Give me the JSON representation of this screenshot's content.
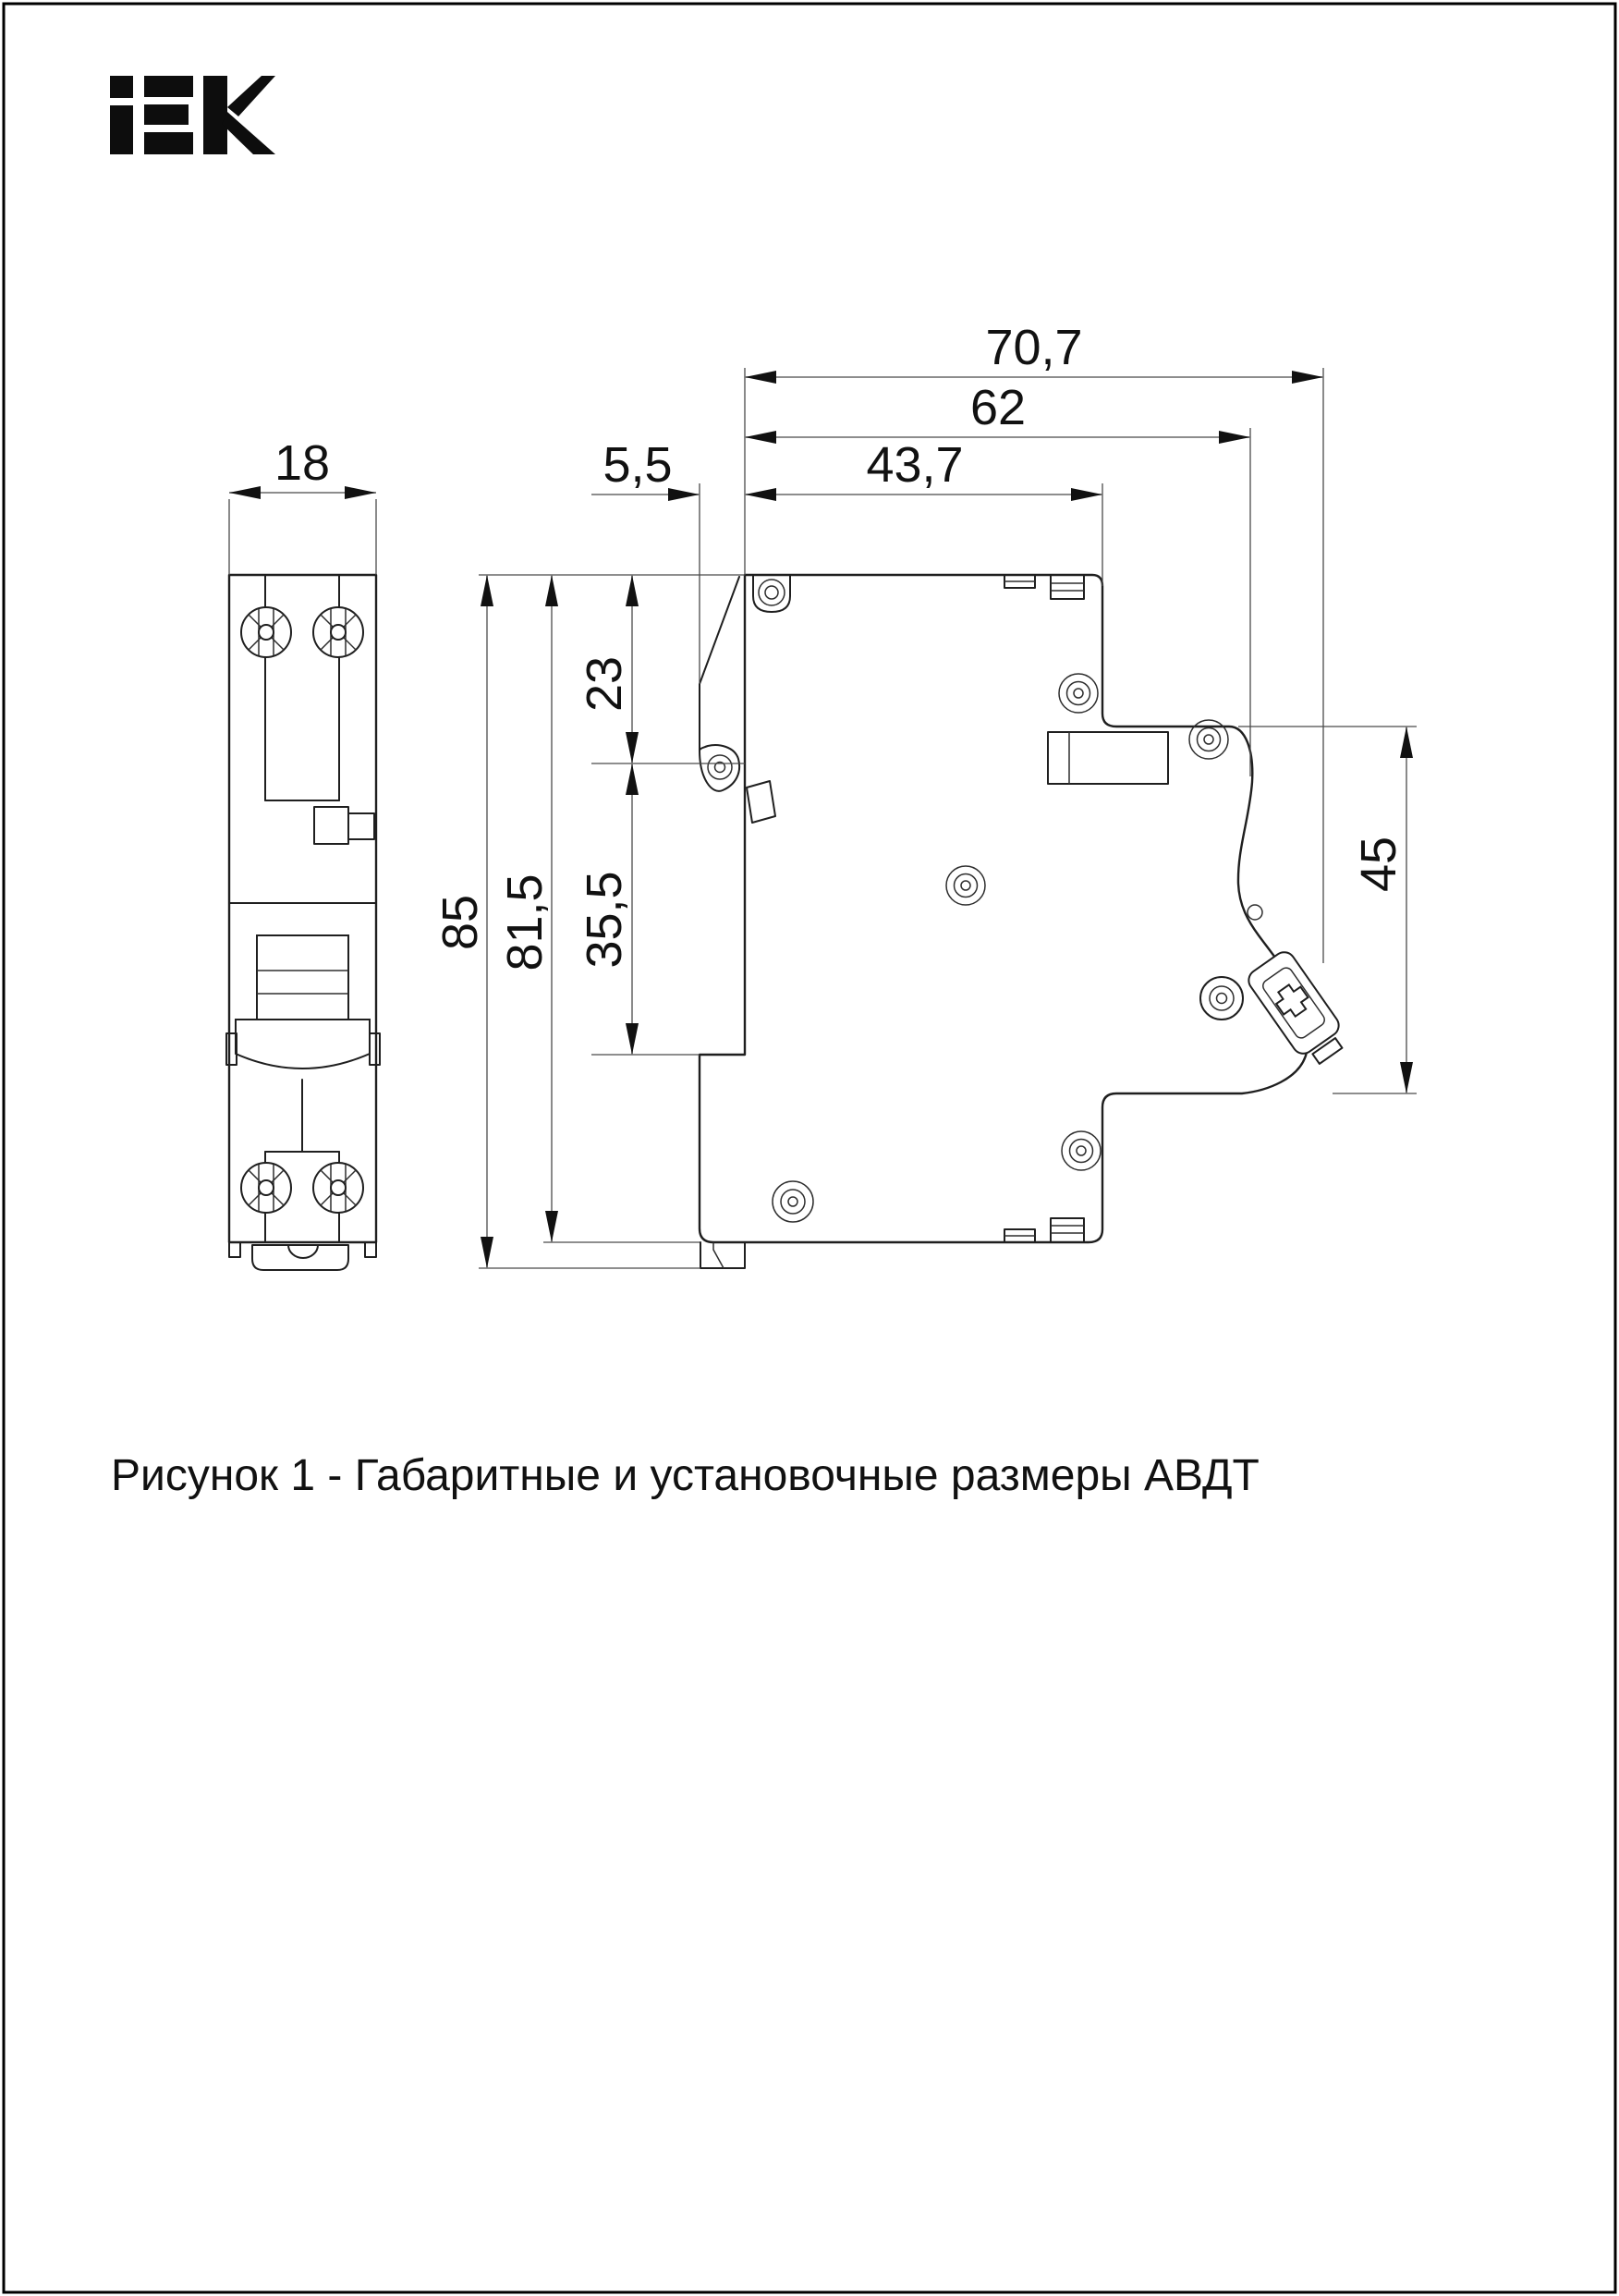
{
  "page": {
    "background": "#ffffff",
    "border_color": "#000000"
  },
  "logo": {
    "brand": "iEK"
  },
  "figure": {
    "caption": "Рисунок 1 - Габаритные и установочные размеры АВДТ"
  },
  "dims": {
    "total_depth": "70,7",
    "upper_depth": "62",
    "case_depth": "43,7",
    "rail_clip_offset": "5,5",
    "module_width": "18",
    "rail_top_offset": "23",
    "total_height": "85",
    "case_height": "81,5",
    "rail_span": "35,5",
    "front_face_height": "45"
  }
}
